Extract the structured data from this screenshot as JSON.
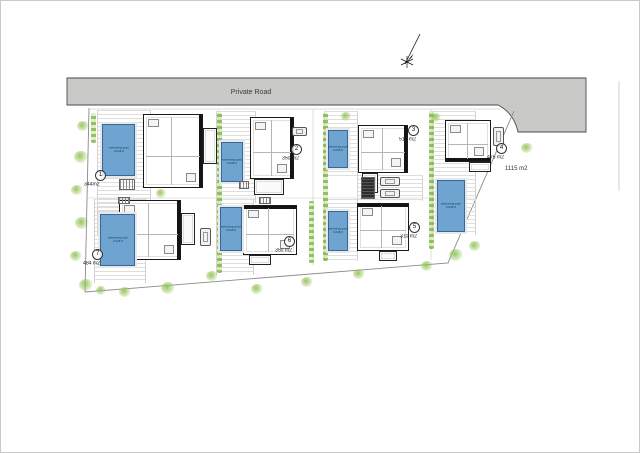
{
  "road": {
    "label": "Private Road"
  },
  "plots": [
    {
      "num": "1",
      "area": "344m2"
    },
    {
      "num": "2",
      "area": "350 m2"
    },
    {
      "num": "3",
      "area": "510 m2"
    },
    {
      "num": "4",
      "area": "475 m2"
    },
    {
      "num": "5",
      "area": "310 m2"
    },
    {
      "num": "6",
      "area": "350 m2"
    },
    {
      "num": "7",
      "area": "484 m2"
    }
  ],
  "right_plot_area": "1115 m2",
  "pool": {
    "line1": "swimming pool",
    "line2": "4.0x8.0"
  },
  "icons": {
    "north_arrow": "north-arrow"
  },
  "colors": {
    "road_fill": "#c9c9c7",
    "road_stroke": "#4a4a4a",
    "pool_fill": "#6fa3d0",
    "pool_border": "#35689c",
    "green": "#8cbe50",
    "wall": "#141414",
    "boundary": "#8a8a8a"
  }
}
